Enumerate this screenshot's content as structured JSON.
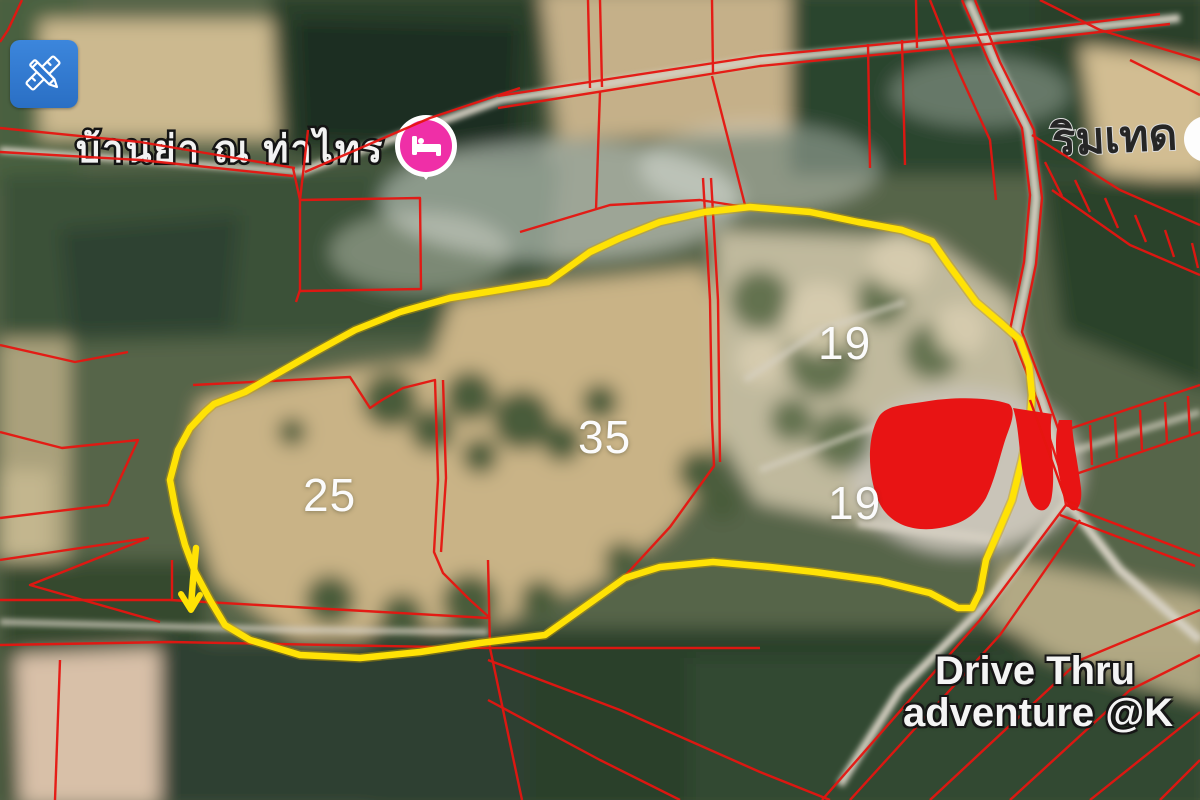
{
  "map": {
    "toolbar": {
      "measure_button_icon": "ruler-pencil-icon"
    },
    "labels": {
      "place_top_left": "บ้านย่า ณ ท่าไทร",
      "place_top_right": "ริมเทด",
      "bottom_right_line1": "Drive Thru",
      "bottom_right_line2": "adventure @K"
    },
    "parcels": [
      {
        "id": "parcel-19-north",
        "label": "19"
      },
      {
        "id": "parcel-35",
        "label": "35"
      },
      {
        "id": "parcel-25",
        "label": "25"
      },
      {
        "id": "parcel-19-south",
        "label": "19"
      }
    ],
    "pins": {
      "lodging_pin": "bed-icon"
    },
    "colors": {
      "boundary_yellow": "#ffe205",
      "cadastral_red": "#e61510",
      "building_red": "#e81414",
      "tool_button_blue": "#2e77d0",
      "lodging_pin_pink": "#ef2fa7"
    }
  }
}
